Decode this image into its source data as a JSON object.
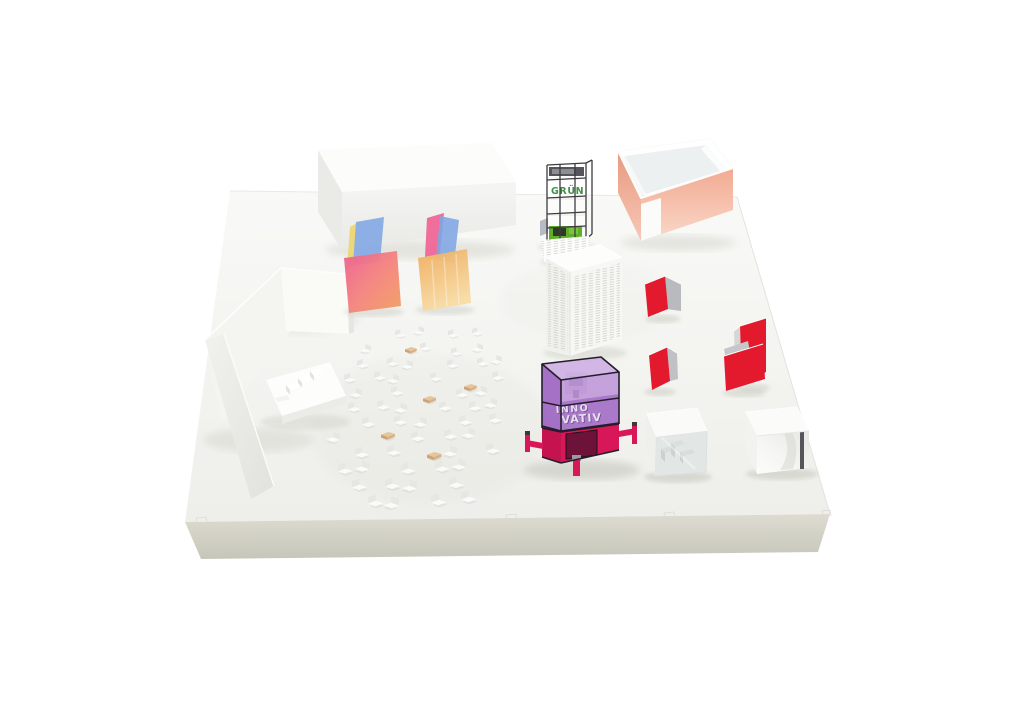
{
  "scene": {
    "description": "Photograph of a white architectural scale model of an exhibition hall on a thick white plinth, with small colored acrylic structures, scattered miniature white chairs, a green scaffold tower, a translucent purple machine cube and red folded screens."
  },
  "labels": {
    "tower_sign": "GRÜN",
    "cube_sign_line1": "INNO",
    "cube_sign_line2": "VATIV"
  },
  "colors": {
    "background": "#ffffff",
    "platform_top": "#f5f5f2",
    "platform_side": "#d0d0c5",
    "accent_green": "#5fae27",
    "sign_green": "#3e9444",
    "accent_red": "#e3192e",
    "accent_magenta": "#d81758",
    "accent_purple": "#a66cc8",
    "accent_salmon": "#f2a78f",
    "panel_blue": "#7fa6e4",
    "panel_pink": "#ef6394",
    "panel_yellow": "#ecd66e",
    "panel_orange": "#f0ad5f",
    "wood_tan": "#e6c59b",
    "frame_dark": "#3d3d40"
  }
}
